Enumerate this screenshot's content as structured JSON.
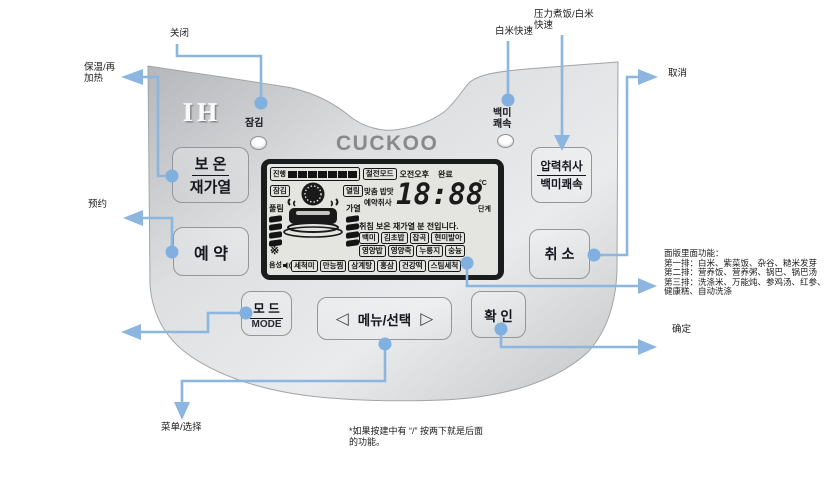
{
  "colors": {
    "annotation_blue": "#8cb6e0",
    "annotation_dot": "#7fb0e0",
    "panel_silver": "#d9dbdd",
    "lcd_background": "#e4e4e0",
    "lcd_ink": "#161616",
    "logo_gray": "#87898c"
  },
  "brand": {
    "logo": "CUCKOO",
    "heating_type": "IH"
  },
  "device": {
    "lock_button_label": "잠김",
    "quick_button_label_line1": "백미",
    "quick_button_label_line2": "쾌속",
    "buttons": {
      "keep_warm_line1": "보 온",
      "keep_warm_line2": "재가열",
      "reserve": "예 약",
      "pressure_line1": "압력취사",
      "pressure_line2": "백미쾌속",
      "cancel": "취 소",
      "mode_line1": "모 드",
      "mode_line2": "MODE",
      "menu": "메뉴/선택",
      "menu_left": "◁",
      "menu_right": "▷",
      "confirm": "확 인"
    }
  },
  "lcd": {
    "progress": "진행",
    "power_save": "절전모드",
    "am_pm": "오전오후",
    "complete": "완료",
    "lock": "잠김",
    "open": "열림",
    "release": "풀림",
    "heat": "가열",
    "custom_taste": "맞춤 밥맛",
    "reserve_cook": "예약취사",
    "time": "18:88",
    "unit_temp": "°C",
    "unit_stage": "단계",
    "status": "취침 보온 재가열 분 전입니다.",
    "voice": "음성",
    "snowflake": "※",
    "menu_row1": [
      "백미",
      "김초밥",
      "잡곡",
      "현미발아"
    ],
    "menu_row2": [
      "영양밥",
      "영양죽",
      "누룽지",
      "숭늉"
    ],
    "menu_row3": [
      "세척미",
      "만능찜",
      "삼계탕",
      "홍삼",
      "건강떡",
      "스팀세척"
    ]
  },
  "annotations": {
    "close": "关闭",
    "keep_warm_line1": "保温/再",
    "keep_warm_line2": "加热",
    "reserve": "预约",
    "white_rice_quick": "白米快速",
    "pressure_line1": "压力煮饭/白米",
    "pressure_line2": "快速",
    "cancel": "取消",
    "confirm": "确定",
    "menu_select": "菜单/选择",
    "panel_functions": [
      "面版里面功能：",
      "第一排：白米、紫菜饭、杂谷、糙米发芽",
      "第二排：营养饭、营养粥、锅巴、锅巴汤",
      "第三排：洗涤米、万能炖、参鸡汤、红参、",
      "健康糕、自动洗涤"
    ],
    "footnote": [
      "*如果按建中有 “/” 按两下就是后面",
      "的功能。"
    ]
  }
}
